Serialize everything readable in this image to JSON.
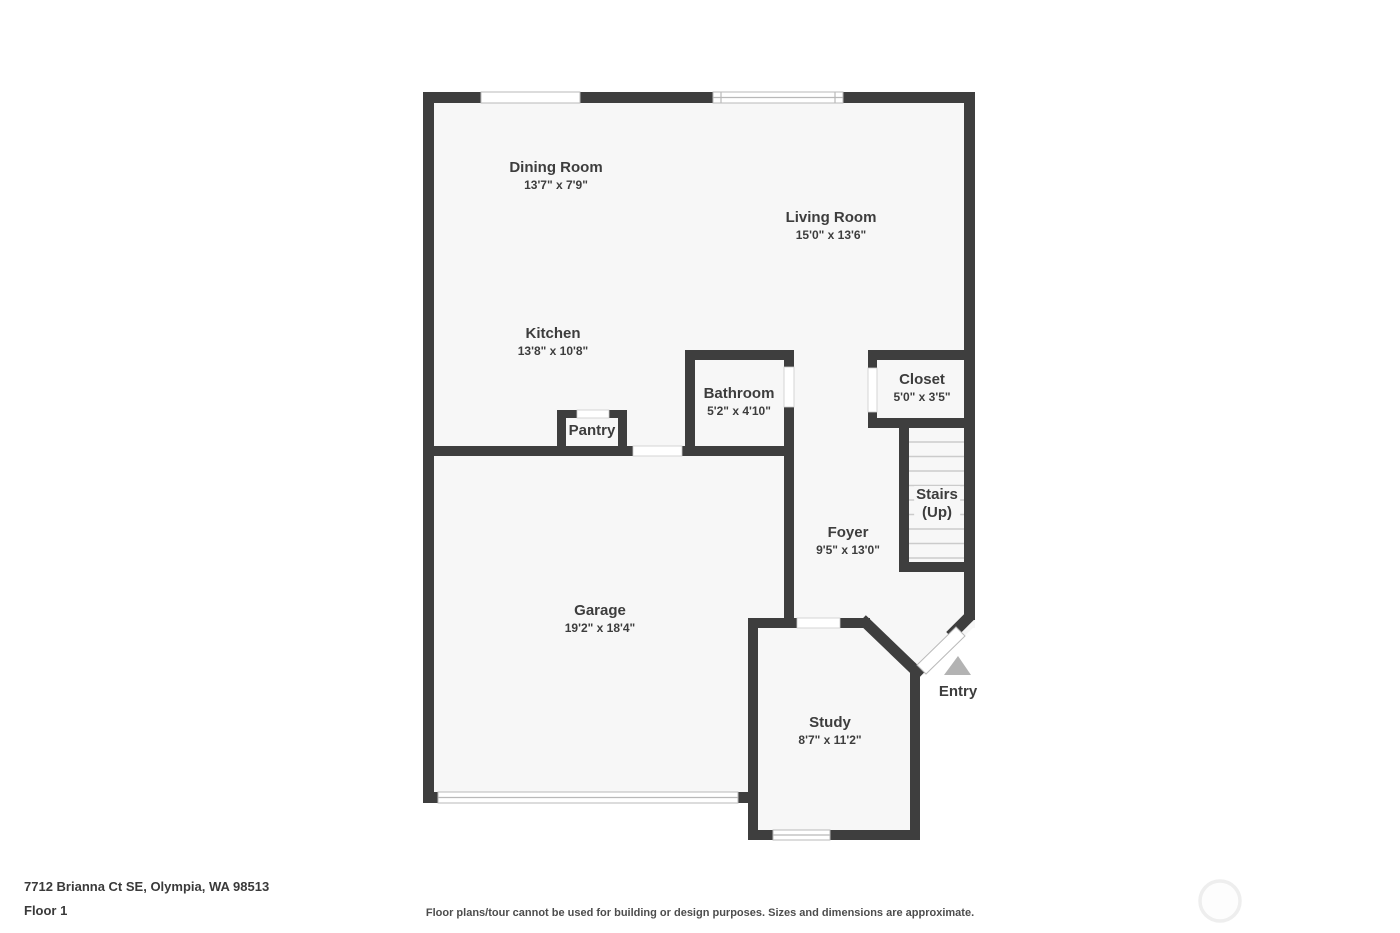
{
  "floorplan": {
    "rooms": [
      {
        "id": "dining-room",
        "name": "Dining Room",
        "dimensions": "13'7\" x 7'9\""
      },
      {
        "id": "living-room",
        "name": "Living Room",
        "dimensions": "15'0\" x 13'6\""
      },
      {
        "id": "kitchen",
        "name": "Kitchen",
        "dimensions": "13'8\" x 10'8\""
      },
      {
        "id": "bathroom",
        "name": "Bathroom",
        "dimensions": "5'2\" x 4'10\""
      },
      {
        "id": "closet",
        "name": "Closet",
        "dimensions": "5'0\" x 3'5\""
      },
      {
        "id": "foyer",
        "name": "Foyer",
        "dimensions": "9'5\" x 13'0\""
      },
      {
        "id": "garage",
        "name": "Garage",
        "dimensions": "19'2\" x 18'4\""
      },
      {
        "id": "study",
        "name": "Study",
        "dimensions": "8'7\" x 11'2\""
      }
    ],
    "pantry_label": "Pantry",
    "stairs_label_line1": "Stairs",
    "stairs_label_line2": "(Up)",
    "entry_label": "Entry"
  },
  "footer": {
    "address": "7712 Brianna Ct SE, Olympia, WA 98513",
    "floor_label": "Floor 1",
    "disclaimer": "Floor plans/tour cannot be used for building or design purposes. Sizes and dimensions are approximate."
  },
  "colors": {
    "wall": "#3e3e3e",
    "floor": "#f7f7f7",
    "label_text": "#3d3d3d",
    "entry_arrow": "#b3b3b3",
    "stair_tread": "#cbcbcb",
    "window_outline": "#b9b9b9",
    "logo_ring": "#eeeeee"
  }
}
